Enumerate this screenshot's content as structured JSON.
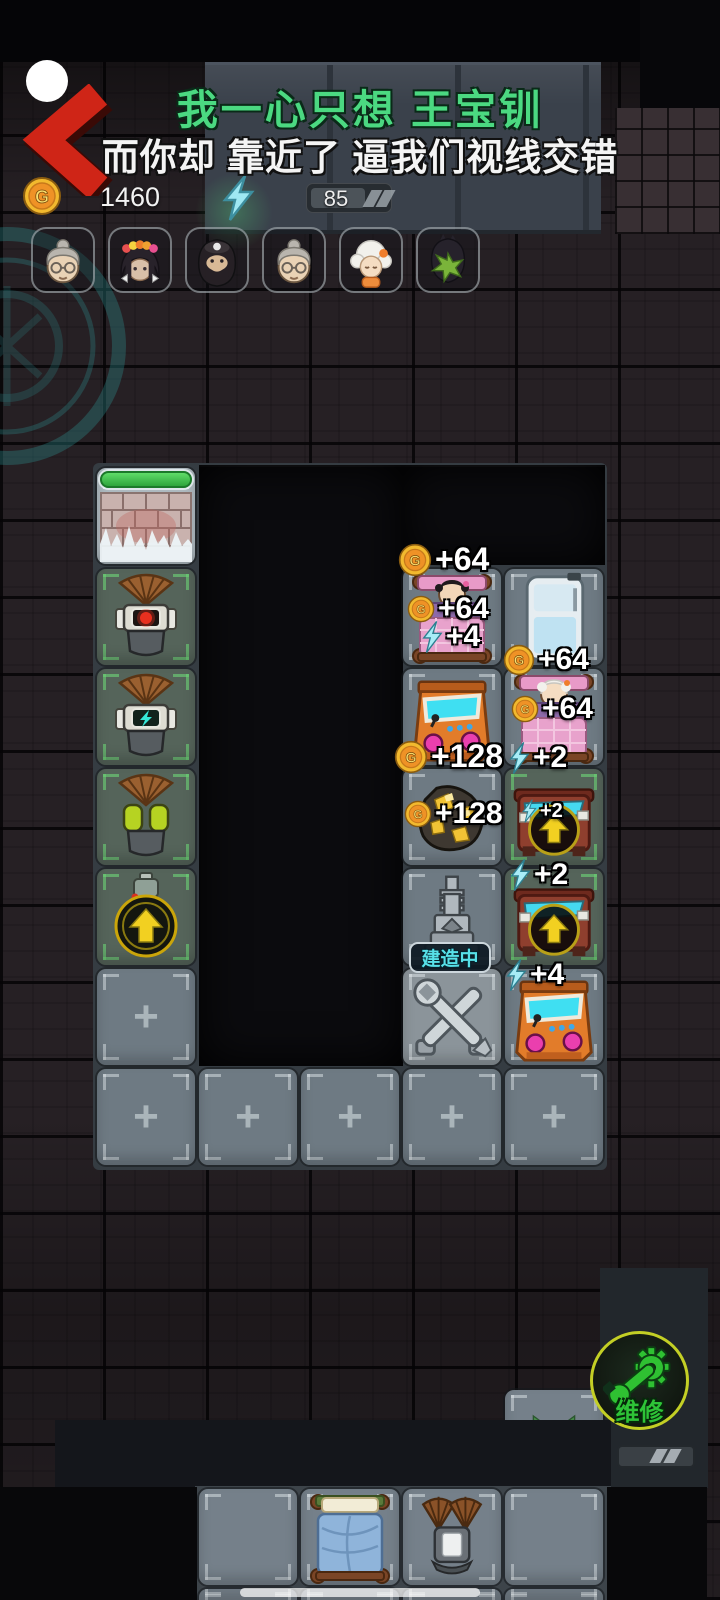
{
  "lyrics": {
    "line1": "我一心只想 王宝钏",
    "line2": "而你却 靠近了 逼我们视线交错"
  },
  "status_bar": {
    "coin_count": "1460",
    "energy_value": "85"
  },
  "icons": {
    "coin_letter": "G"
  },
  "team_avatars": [
    {
      "name": "grandma-glasses"
    },
    {
      "name": "girl-flower-crown"
    },
    {
      "name": "bearded-man-cap"
    },
    {
      "name": "grandma-glasses-2"
    },
    {
      "name": "white-hair-girl"
    },
    {
      "name": "leaf-masked-person"
    }
  ],
  "grid": {
    "empty_tile_glyph": "+"
  },
  "floating_indicators": [
    {
      "icon": "coin",
      "value": "+64"
    },
    {
      "icon": "coin",
      "value": "+64"
    },
    {
      "icon": "bolt",
      "value": "+4"
    },
    {
      "icon": "coin",
      "value": "+64"
    },
    {
      "icon": "coin",
      "value": "+64"
    },
    {
      "icon": "bolt",
      "value": "+2"
    },
    {
      "icon": "coin",
      "value": "+128"
    },
    {
      "icon": "coin",
      "value": "+128"
    },
    {
      "icon": "bolt",
      "value": "+2"
    },
    {
      "icon": "bolt",
      "value": "+2"
    },
    {
      "icon": "bolt",
      "value": "+4"
    }
  ],
  "labels": {
    "under_construction": "建造中",
    "repair": "维修"
  },
  "colors": {
    "lyric_green": "#4bd981",
    "accent_green": "#2ec437",
    "coin_gold": "#f2b92e",
    "energy_cyan": "#9fe8f2",
    "health_green": "#3dbd4a"
  }
}
